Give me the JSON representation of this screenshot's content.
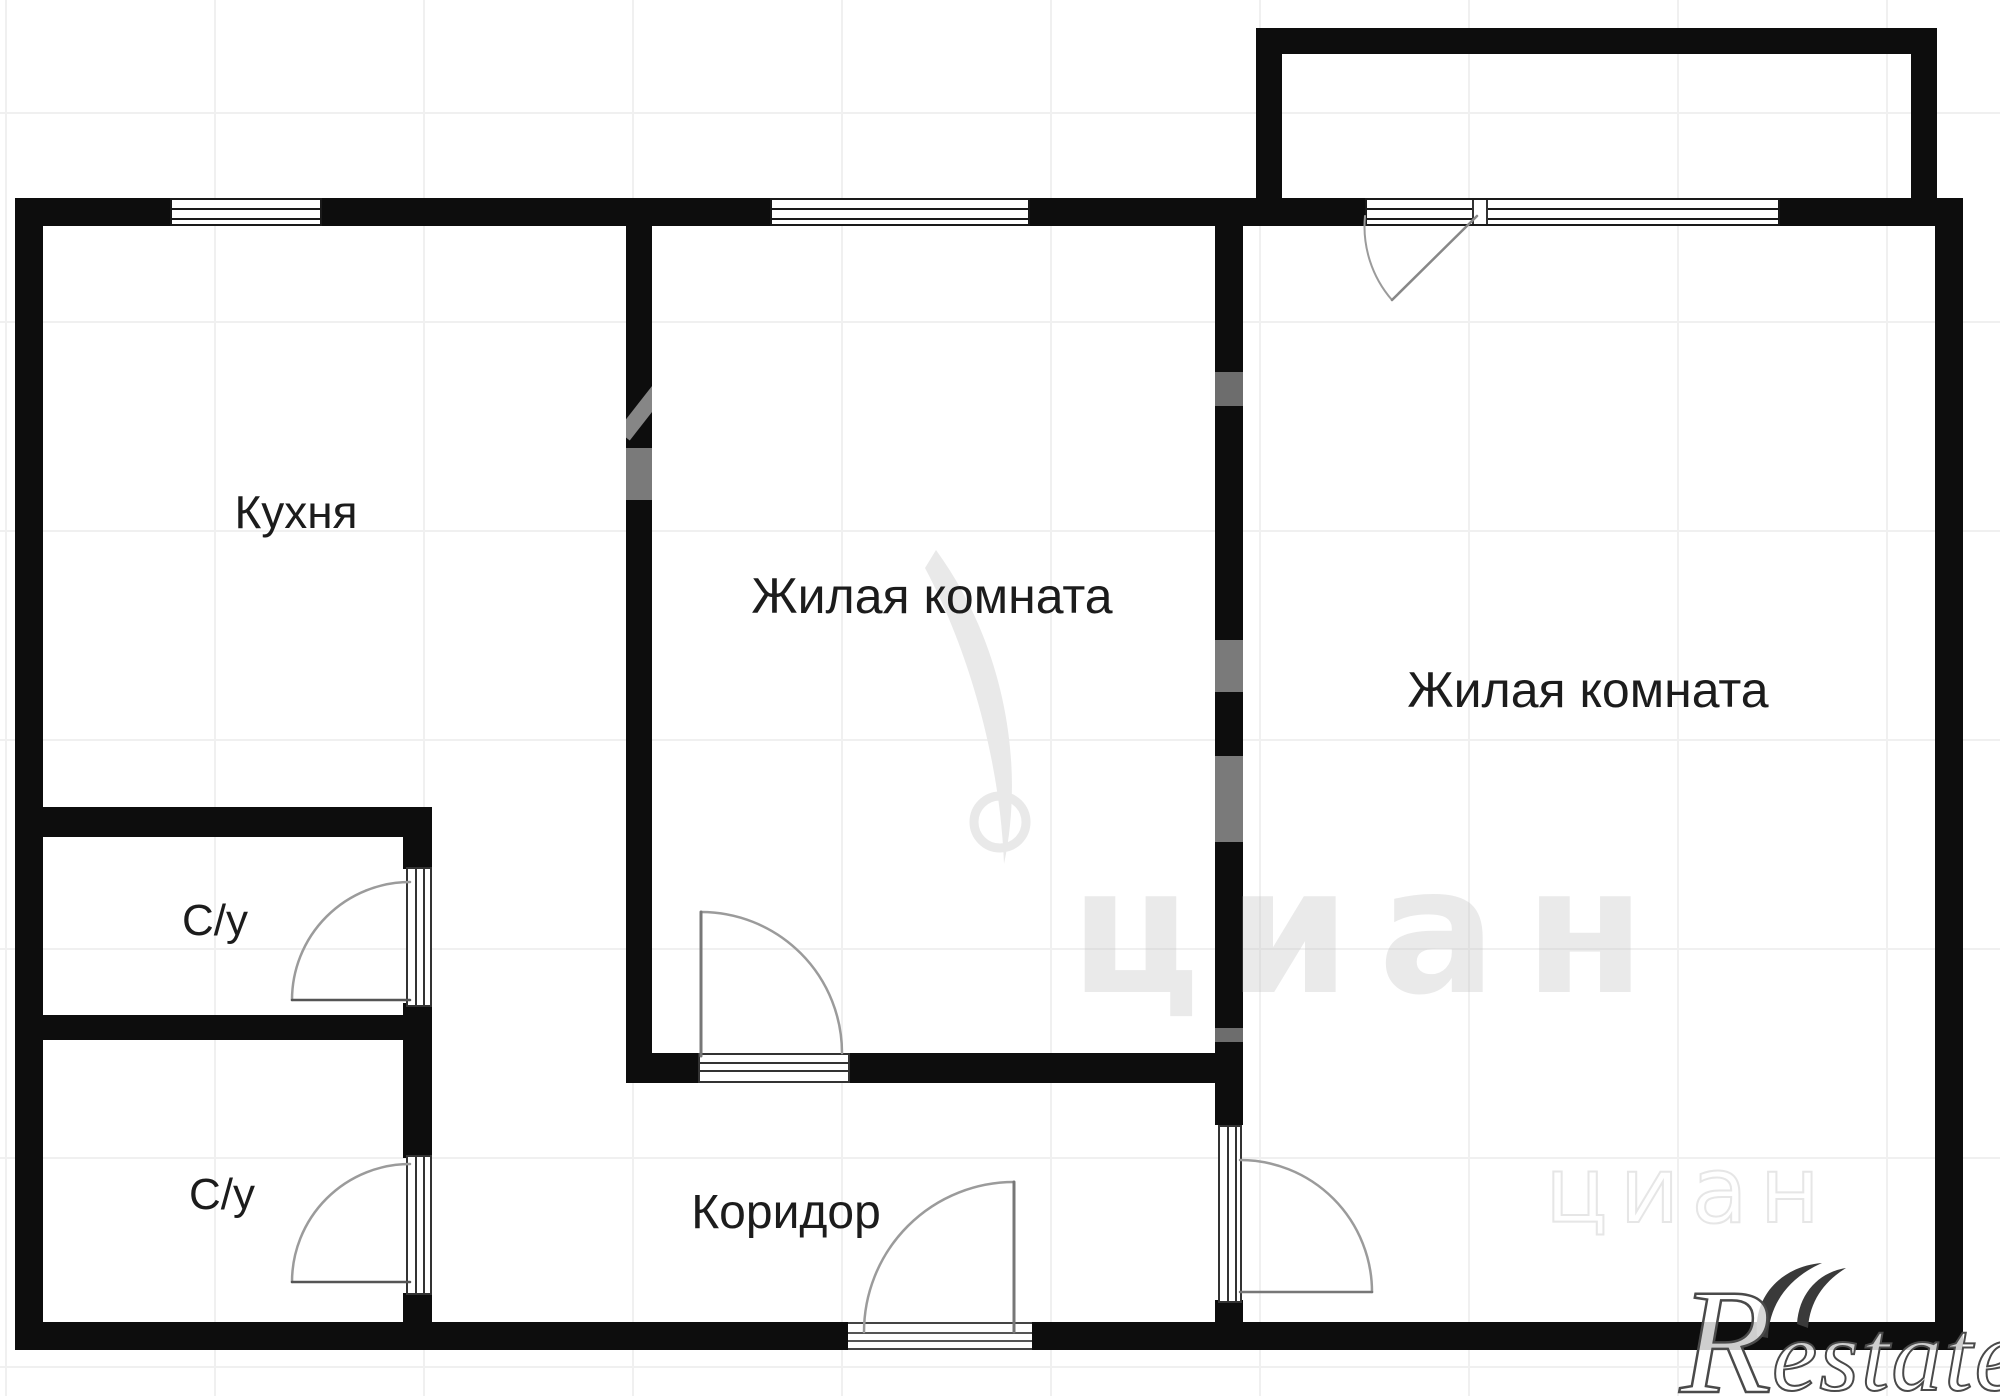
{
  "plan": {
    "type": "apartment-floor-plan",
    "background_color": "#ffffff",
    "wall_color": "#0d0d0d",
    "grid_color": "#f0f0f0",
    "door_arc_color": "#9b9b9b",
    "label_color": "#1c1c1c",
    "watermark_color": "#ececec"
  },
  "rooms": [
    {
      "id": "kitchen",
      "label": "Кухня"
    },
    {
      "id": "living-room-1",
      "label": "Жилая комната"
    },
    {
      "id": "living-room-2",
      "label": "Жилая комната"
    },
    {
      "id": "bathroom-1",
      "label": "С/у"
    },
    {
      "id": "bathroom-2",
      "label": "С/у"
    },
    {
      "id": "corridor",
      "label": "Коридор"
    }
  ],
  "watermark": {
    "site": "циан",
    "brand_initial": "R",
    "brand_rest": "estate"
  }
}
